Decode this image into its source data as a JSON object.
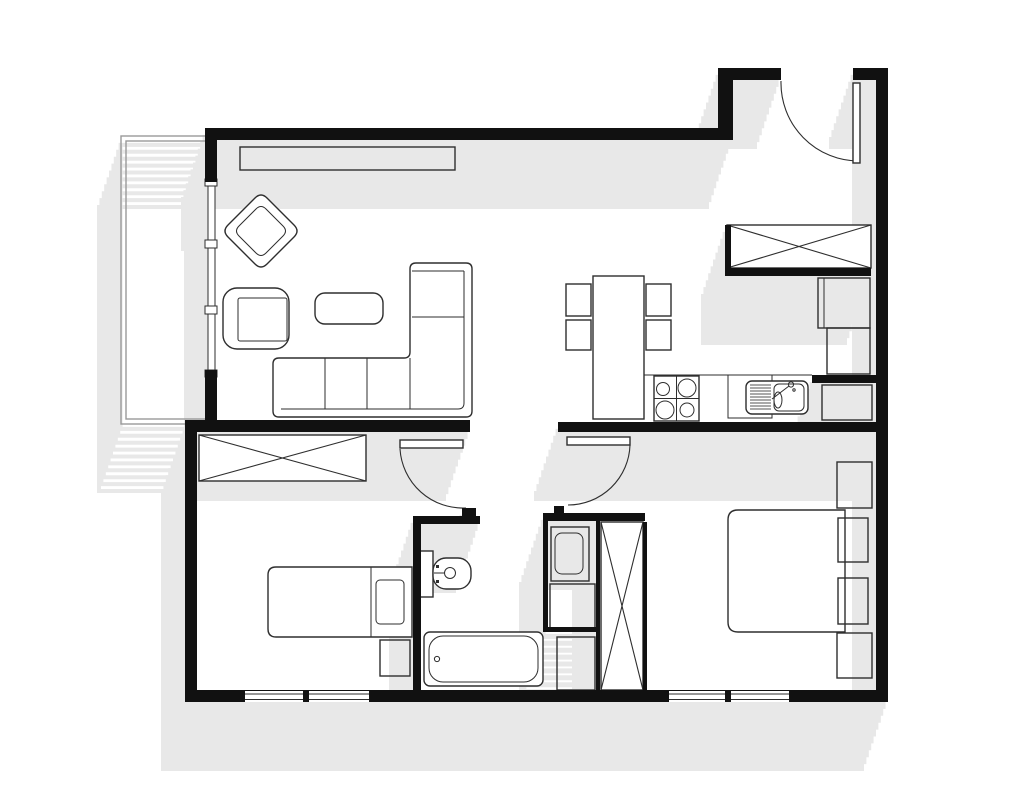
{
  "document": {
    "type": "architectural-floor-plan",
    "style": "2D top-down plan, black walls on white floor with light gray diagonal drop shadows",
    "text_labels": []
  },
  "colors": {
    "background": "#ffffff",
    "walls": "#111111",
    "furniture_outline": "#2e2e2e",
    "shadow": "#e8e8e8",
    "balcony_outline": "#9a9a9a",
    "gray_fill": "#ededed"
  },
  "rooms": [
    {
      "name": "living-dining-kitchen",
      "position": "top",
      "features": [
        "corner-sofa",
        "armchair",
        "coffee-table",
        "rug",
        "tv-sideboard",
        "dining-table-with-4-chairs",
        "kitchen-counter-with-hob-and-sink",
        "tall-fridge-unit"
      ]
    },
    {
      "name": "entry-hall",
      "position": "top-right",
      "features": [
        "entry-door",
        "built-in-wardrobe-crossed",
        "cabinet"
      ]
    },
    {
      "name": "bedroom-1",
      "position": "bottom-left",
      "features": [
        "single-bed",
        "pillow",
        "nightstand",
        "built-in-wardrobe-crossed",
        "window"
      ]
    },
    {
      "name": "bathroom",
      "position": "bottom-center",
      "features": [
        "toilet",
        "bathtub",
        "storage-niche",
        "washing-machine"
      ]
    },
    {
      "name": "bedroom-2",
      "position": "bottom-right",
      "features": [
        "double-bed",
        "two-pillows",
        "two-nightstands",
        "built-in-wardrobe-crossed",
        "window"
      ]
    },
    {
      "name": "balcony",
      "position": "left",
      "features": [
        "open-railing",
        "glazed-wall-to-living-room"
      ]
    }
  ],
  "openings": {
    "doors": [
      "entry-door-top-right-with-swing-arc",
      "bedroom-1-door-with-swing-arc",
      "bedroom-2-door-with-swing-arc",
      "bathroom-open-doorway"
    ],
    "windows": [
      "living-room-glazed-wall-to-balcony",
      "bedroom-1-bottom-window",
      "bedroom-2-bottom-window"
    ]
  },
  "shadow": {
    "direction": "down-left",
    "offset_total_px": [
      -24,
      69
    ]
  }
}
